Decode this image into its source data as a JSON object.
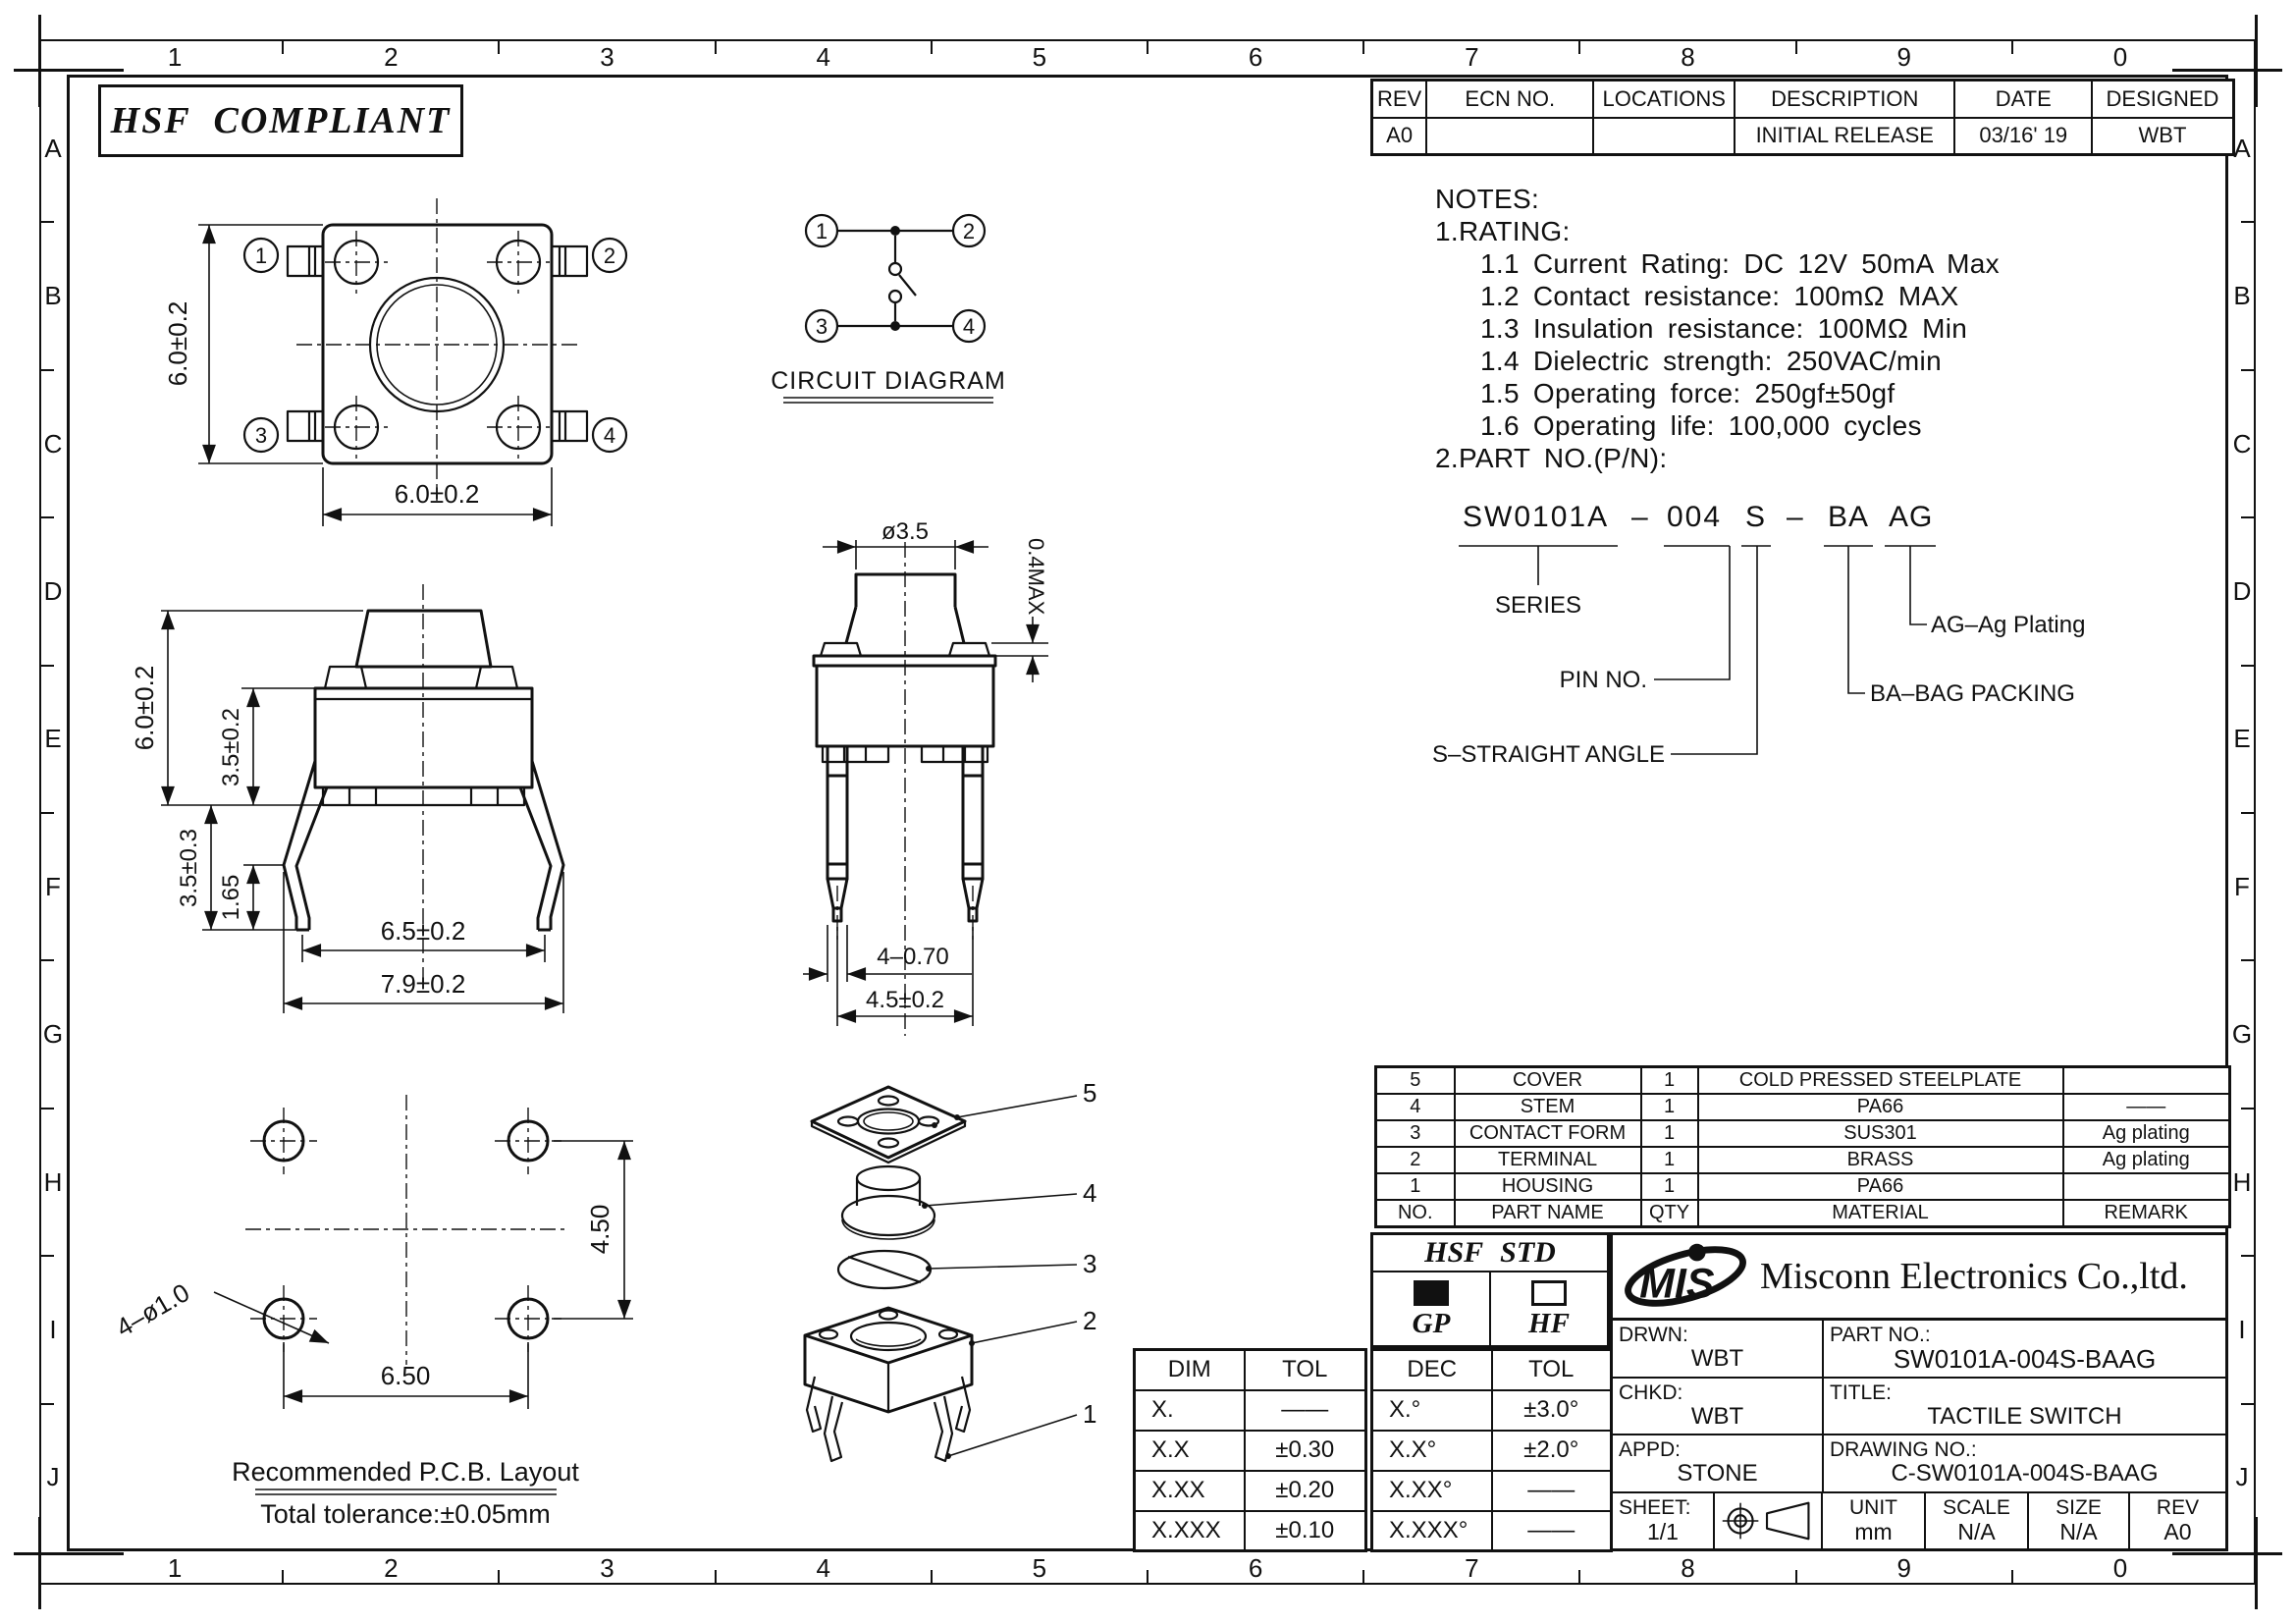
{
  "frame": {
    "numbers": [
      "1",
      "2",
      "3",
      "4",
      "5",
      "6",
      "7",
      "8",
      "9",
      "0"
    ],
    "letters": [
      "A",
      "B",
      "C",
      "D",
      "E",
      "F",
      "G",
      "H",
      "I",
      "J"
    ]
  },
  "badge": "HSF COMPLIANT",
  "revision_table": {
    "headers": [
      "REV",
      "ECN NO.",
      "LOCATIONS",
      "DESCRIPTION",
      "DATE",
      "DESIGNED"
    ],
    "row": [
      "A0",
      "",
      "",
      "INITIAL RELEASE",
      "03/16' 19",
      "WBT"
    ]
  },
  "notes": {
    "heading": "NOTES:",
    "rating": "1.RATING:",
    "items": [
      "1.1 Current Rating: DC 12V 50mA Max",
      "1.2 Contact resistance: 100mΩ MAX",
      "1.3 Insulation resistance: 100MΩ Min",
      "1.4 Dielectric strength: 250VAC/min",
      "1.5 Operating force: 250gf±50gf",
      "1.6 Operating life: 100,000 cycles"
    ],
    "part_heading": "2.PART NO.(P/N):"
  },
  "part_number": {
    "series": "SW0101A",
    "dash1": "–",
    "pin": "004",
    "angle": "S",
    "dash2": "–",
    "packing": "BA",
    "plating": "AG",
    "series_label": "SERIES",
    "pin_label": "PIN NO.",
    "angle_label": "S–STRAIGHT ANGLE",
    "packing_label": "BA–BAG PACKING",
    "plating_label": "AG–Ag Plating"
  },
  "top_view": {
    "pins": [
      "1",
      "2",
      "3",
      "4"
    ],
    "dim_height": "6.0±0.2",
    "dim_width": "6.0±0.2"
  },
  "circuit": {
    "pins": [
      "1",
      "2",
      "3",
      "4"
    ],
    "title": "CIRCUIT DIAGRAM"
  },
  "front_view": {
    "dim_total_height": "6.0±0.2",
    "dim_body_height": "3.5±0.2",
    "dim_leg_length": "3.5±0.3",
    "dim_leg_tip": "1.65",
    "dim_feet_span": "6.5±0.2",
    "dim_outer_span": "7.9±0.2"
  },
  "side_view": {
    "dim_stem_dia": "ø3.5",
    "dim_stem_height": "0.4MAX",
    "dim_pin_width": "4–0.70",
    "dim_pin_pitch": "4.5±0.2"
  },
  "pcb": {
    "dim_holes": "4–ø1.0",
    "dim_pitch_h": "6.50",
    "dim_pitch_v": "4.50",
    "title": "Recommended P.C.B. Layout",
    "subtitle": "Total tolerance:±0.05mm"
  },
  "exploded": {
    "labels": [
      "5",
      "4",
      "3",
      "2",
      "1"
    ]
  },
  "bom": {
    "headers": [
      "NO.",
      "PART NAME",
      "QTY",
      "MATERIAL",
      "REMARK"
    ],
    "rows": [
      [
        "5",
        "COVER",
        "1",
        "COLD PRESSED STEELPLATE",
        ""
      ],
      [
        "4",
        "STEM",
        "1",
        "PA66",
        "——"
      ],
      [
        "3",
        "CONTACT FORM",
        "1",
        "SUS301",
        "Ag plating"
      ],
      [
        "2",
        "TERMINAL",
        "1",
        "BRASS",
        "Ag plating"
      ],
      [
        "1",
        "HOUSING",
        "1",
        "PA66",
        ""
      ]
    ]
  },
  "hsf_std": {
    "title": "HSF STD",
    "gp": "GP",
    "hf": "HF"
  },
  "dim_tol": {
    "headers": [
      "DIM",
      "TOL"
    ],
    "rows": [
      [
        "X.",
        "——"
      ],
      [
        "X.X",
        "±0.30"
      ],
      [
        "X.XX",
        "±0.20"
      ],
      [
        "X.XXX",
        "±0.10"
      ]
    ]
  },
  "dec_tol": {
    "headers": [
      "DEC",
      "TOL"
    ],
    "rows": [
      [
        "X.°",
        "±3.0°"
      ],
      [
        "X.X°",
        "±2.0°"
      ],
      [
        "X.XX°",
        "——"
      ],
      [
        "X.XXX°",
        "——"
      ]
    ]
  },
  "title_block": {
    "logo": "MIS",
    "company": "Misconn Electronics Co.,ltd.",
    "drwn_label": "DRWN:",
    "drwn": "WBT",
    "part_no_label": "PART NO.:",
    "part_no": "SW0101A-004S-BAAG",
    "chkd_label": "CHKD:",
    "chkd": "WBT",
    "title_label": "TITLE:",
    "title": "TACTILE SWITCH",
    "appd_label": "APPD:",
    "appd": "STONE",
    "drawing_no_label": "DRAWING NO.:",
    "drawing_no": "C-SW0101A-004S-BAAG",
    "sheet_label": "SHEET:",
    "sheet": "1/1",
    "unit_label": "UNIT",
    "unit": "mm",
    "scale_label": "SCALE",
    "scale": "N/A",
    "size_label": "SIZE",
    "size": "N/A",
    "rev_label": "REV",
    "rev": "A0"
  }
}
